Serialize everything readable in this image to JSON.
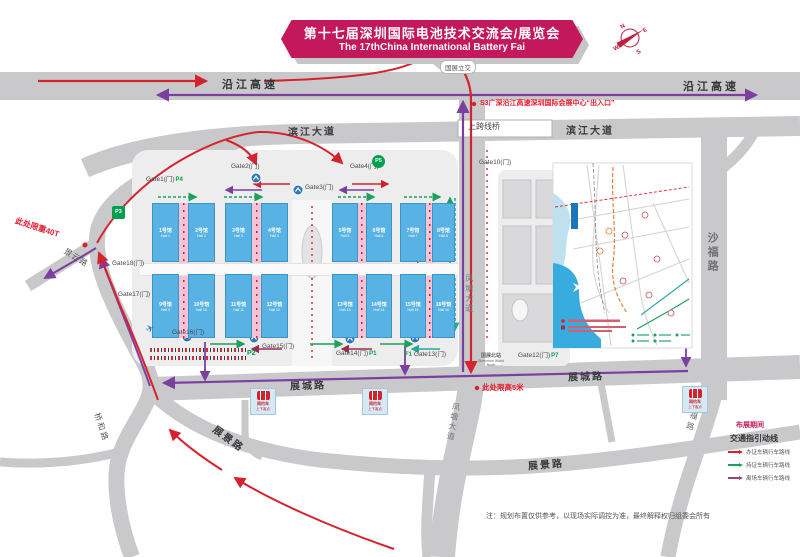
{
  "banner": {
    "title": "第十七届深圳国际电池技术交流会/展览会",
    "subtitle": "The 17thChina International Battery Fai"
  },
  "roads": {
    "yanjiang_left": "沿江高速",
    "yanjiang_right": "沿江高速",
    "binjiang_left": "滨江大道",
    "binjiang_right": "滨江大道",
    "overpass": "上跨线桥",
    "interchange": "国展立交",
    "shafu": "沙福路",
    "shafu_south": "沙福路",
    "fengtang_mid": "凤塘大道",
    "fengtang_south": "凤塘大道",
    "zhancheng_left": "展城路",
    "zhancheng_right": "展城路",
    "zhanjing_sw": "展景路",
    "zhanjing_se": "展景路",
    "qiaohe": "桥和路",
    "jingyun": "景云路"
  },
  "notices": {
    "s3_exit": "S3广深沿江高速深圳国际会展中心“出入口”",
    "weight_limit": "此处限重40T",
    "height_limit": "此处限高5米",
    "bottom_note": "注：规划布置仅供参考，以现场实际调控为准，最终解释权归组委会所有"
  },
  "gates": {
    "g1": {
      "label": "Gate1(门)",
      "tag": "P4"
    },
    "g2": {
      "label": "Gate2(门)"
    },
    "g3": {
      "label": "Gate3(门)"
    },
    "g4": {
      "label": "Gate4(门)"
    },
    "g10": {
      "label": "Gate10(门)"
    },
    "g12": {
      "label": "Gate12(门)",
      "tag": "P7"
    },
    "g13": {
      "label": "Gate13(门)",
      "pre": "F1"
    },
    "g14": {
      "label": "Gate14(门)",
      "tag": "P1"
    },
    "g15": {
      "label": "Gate15(门)"
    },
    "g16": {
      "label": "Gate16(门)"
    },
    "g17": {
      "label": "Gate17(门)"
    },
    "g18": {
      "label": "Gate18(门)"
    }
  },
  "parking": {
    "p2": "P2",
    "p3": "P3",
    "p5": "P5"
  },
  "station": {
    "name_cn": "国展北站",
    "name_en": "Shenzhen World North"
  },
  "pickup": {
    "line1": "网约车",
    "line2": "上下客点"
  },
  "halls": {
    "top": [
      {
        "cn": "1号馆",
        "en": "Hall 1"
      },
      {
        "cn": "2号馆",
        "en": "Hall 2"
      },
      {
        "cn": "3号馆",
        "en": "Hall 3"
      },
      {
        "cn": "4号馆",
        "en": "Hall 4"
      },
      {
        "cn": "5号馆",
        "en": "Hall 5"
      },
      {
        "cn": "6号馆",
        "en": "Hall 6"
      },
      {
        "cn": "7号馆",
        "en": "Hall 7"
      },
      {
        "cn": "8号馆",
        "en": "Hall 8"
      }
    ],
    "bottom": [
      {
        "cn": "9号馆",
        "en": "Hall 9"
      },
      {
        "cn": "10号馆",
        "en": "Hall 10"
      },
      {
        "cn": "11号馆",
        "en": "Hall 11"
      },
      {
        "cn": "12号馆",
        "en": "Hall 12"
      },
      {
        "cn": "13号馆",
        "en": "Hall 13"
      },
      {
        "cn": "14号馆",
        "en": "Hall 14"
      },
      {
        "cn": "15号馆",
        "en": "Hall 15"
      },
      {
        "cn": "16号馆",
        "en": "Hall 16"
      }
    ]
  },
  "legend": {
    "title": "布展期间",
    "subtitle": "交通指引动线",
    "items": [
      {
        "label": "办证车辆行车路线",
        "color": "#d5232e"
      },
      {
        "label": "持证车辆行车路线",
        "color": "#1ca05c"
      },
      {
        "label": "离场车辆行车路线",
        "color": "#a04478"
      }
    ]
  },
  "compass": {
    "n": "N",
    "e": "E",
    "s": "S",
    "w": "W"
  },
  "colors": {
    "banner": "#c3185c",
    "road": "#c9c9cb",
    "hall_blue": "#58b2e4",
    "route_red": "#d5232e",
    "route_purple": "#7b3fa0",
    "route_green": "#1ca05c",
    "metro_blue": "#2f77bc",
    "parking_green": "#00a04e"
  }
}
